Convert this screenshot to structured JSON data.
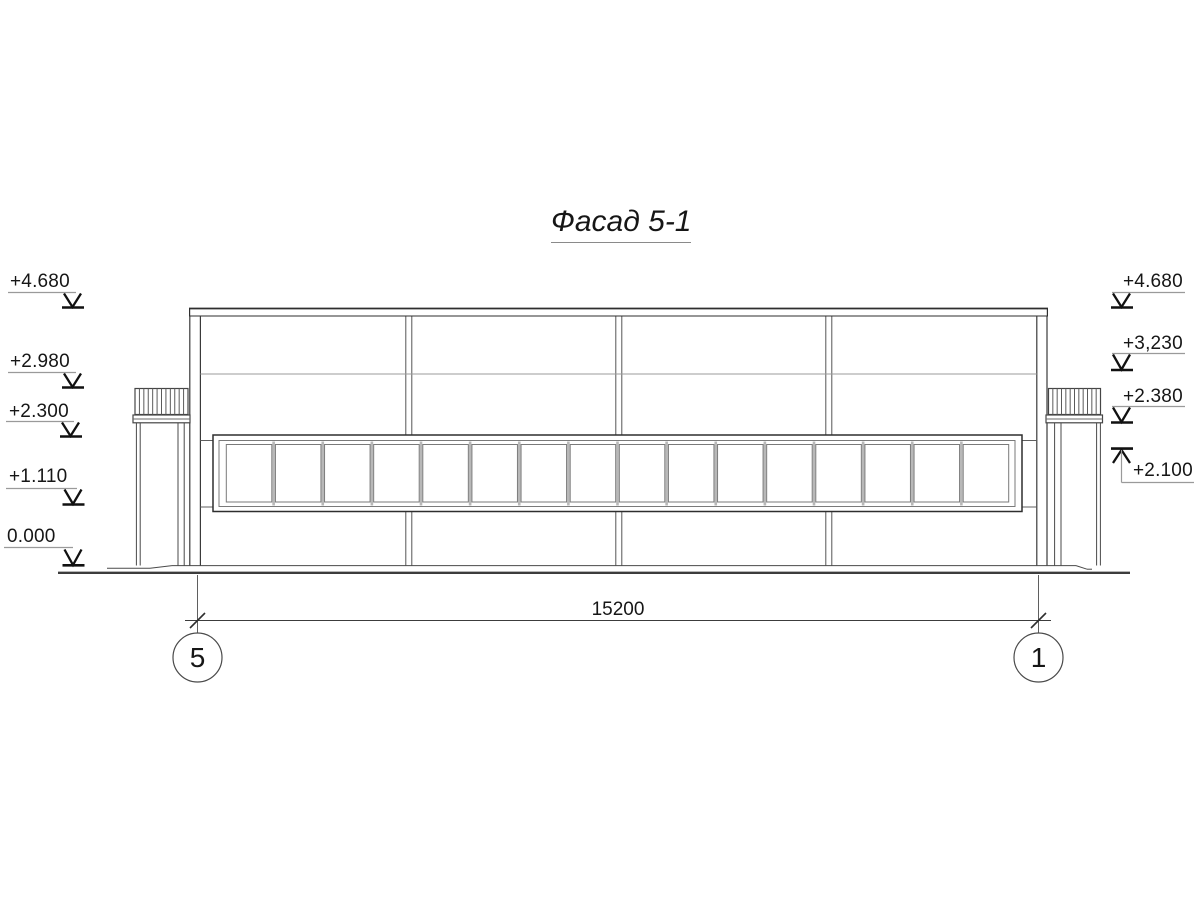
{
  "title": "Фасад 5-1",
  "levels_left": [
    {
      "label": "+4.680"
    },
    {
      "label": "+2.980"
    },
    {
      "label": "+2.300"
    },
    {
      "label": "+1.110"
    },
    {
      "label": "0.000"
    }
  ],
  "levels_right": [
    {
      "label": "+4.680"
    },
    {
      "label": "+3,230"
    },
    {
      "label": "+2.380"
    },
    {
      "label": "+2.100"
    }
  ],
  "dimension_label": "15200",
  "axis_left": "5",
  "axis_right": "1",
  "drawing": {
    "window_pane_count": 16,
    "bay_column_count": 3,
    "canopy_hatch_count": 11
  }
}
